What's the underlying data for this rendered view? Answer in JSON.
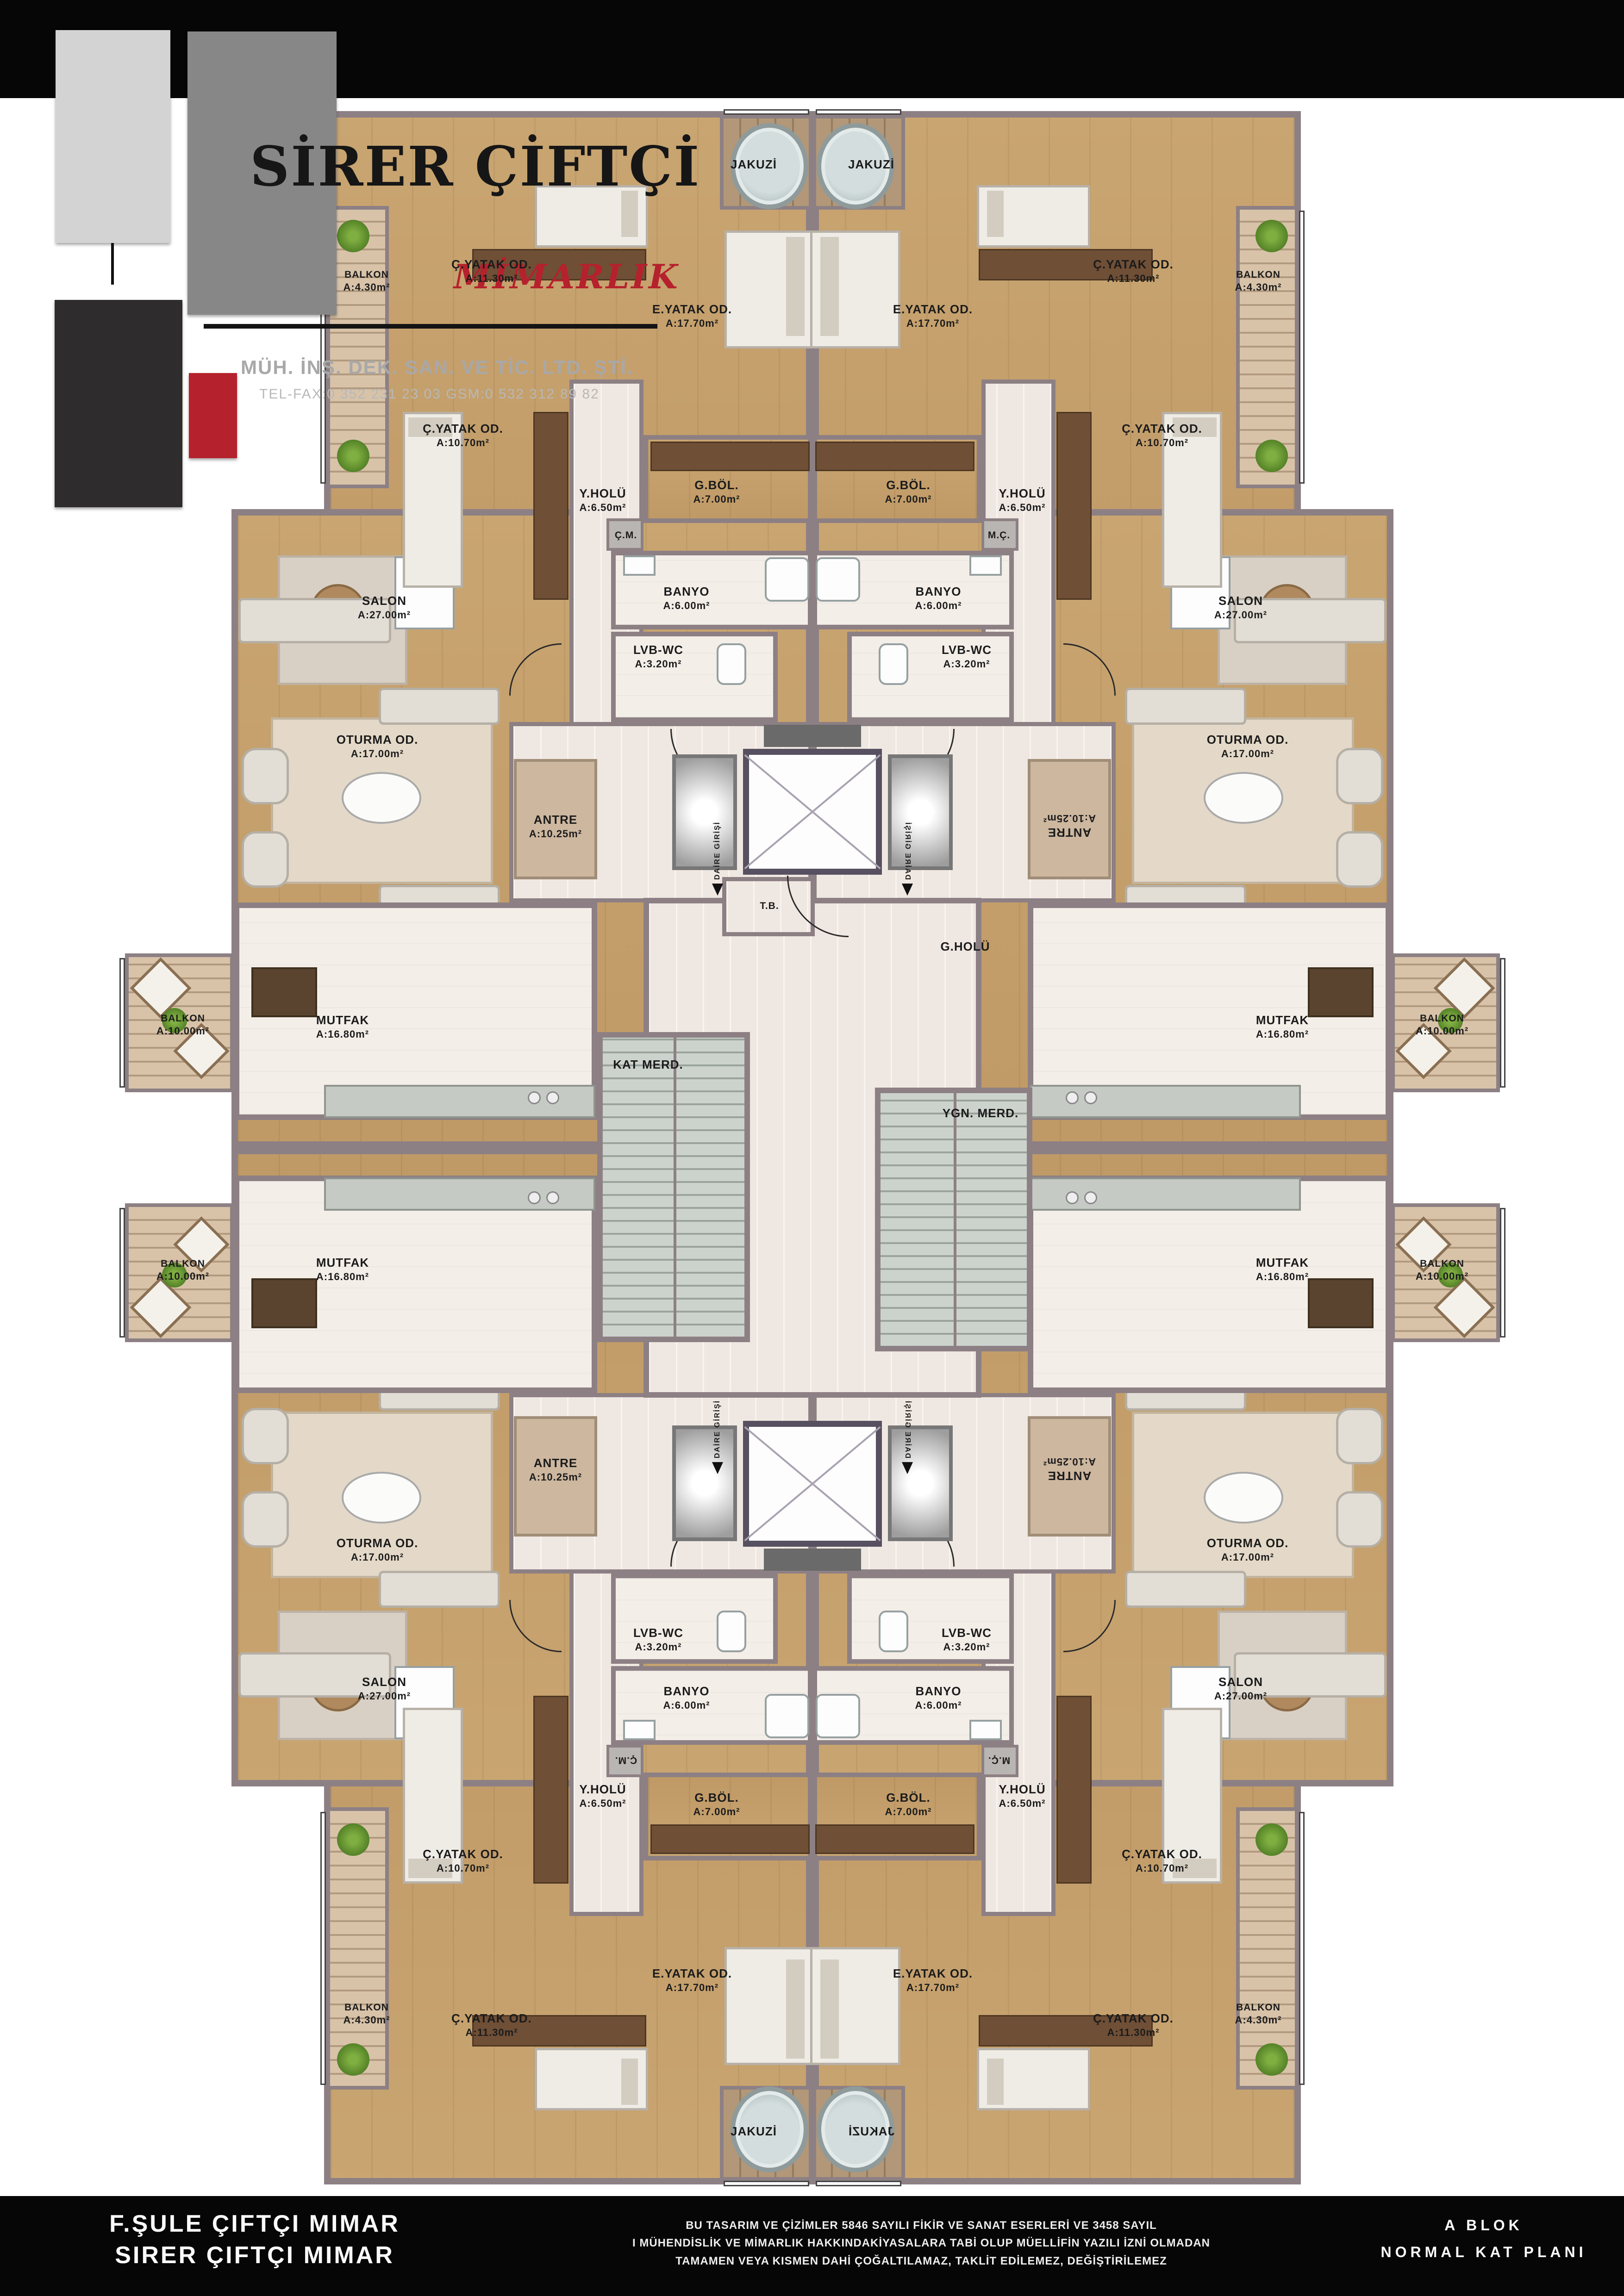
{
  "header": {
    "title": "İBRAHİM BAŞBOĞA",
    "logo": {
      "name": "SİRER ÇİFTÇİ",
      "subtitle": "MİMARLIK",
      "line1": "MÜH. İNŞ. DEK. SAN. VE TİC. LTD. ŞTİ.",
      "line2": "TEL-FAX:0 352 231 23 03    GSM:0 532 312 89 82"
    }
  },
  "plan": {
    "rooms": {
      "jakuzi": {
        "label": "JAKUZİ"
      },
      "balkon430": {
        "label": "BALKON",
        "area": "A:4.30m²"
      },
      "cyatak1130": {
        "label": "Ç.YATAK OD.",
        "area": "A:11.30m²"
      },
      "eyatak": {
        "label": "E.YATAK OD.",
        "area": "A:17.70m²"
      },
      "cyatak1070": {
        "label": "Ç.YATAK OD.",
        "area": "A:10.70m²"
      },
      "yholu": {
        "label": "Y.HOLÜ",
        "area": "A:6.50m²"
      },
      "gbol": {
        "label": "G.BÖL.",
        "area": "A:7.00m²"
      },
      "cm": {
        "label": "Ç.M."
      },
      "mc": {
        "label": "M.Ç."
      },
      "banyo": {
        "label": "BANYO",
        "area": "A:6.00m²"
      },
      "lvbwc": {
        "label": "LVB-WC",
        "area": "A:3.20m²"
      },
      "salon": {
        "label": "SALON",
        "area": "A:27.00m²"
      },
      "oturma": {
        "label": "OTURMA OD.",
        "area": "A:17.00m²"
      },
      "antre": {
        "label": "ANTRE",
        "area": "A:10.25m²"
      },
      "mutfak": {
        "label": "MUTFAK",
        "area": "A:16.80m²"
      },
      "balkon1000": {
        "label": "BALKON",
        "area": "A:10.00m²"
      },
      "katmerd": {
        "label": "KAT MERD."
      },
      "ygnmerd": {
        "label": "YGN. MERD."
      },
      "tb": {
        "label": "T.B."
      },
      "gholu": {
        "label": "G.HOLÜ"
      },
      "daire": {
        "label": "DAİRE GİRİŞİ"
      }
    }
  },
  "footer": {
    "architect1": "F.ŞULE ÇIFTÇI MIMAR",
    "architect2": "SIRER ÇIFTÇI MIMAR",
    "notice1": "BU TASARIM VE ÇİZİMLER 5846 SAYILI FİKİR VE SANAT ESERLERİ VE 3458 SAYIL",
    "notice2": "I MÜHENDİSLİK VE MİMARLIK HAKKINDAKİYASALARA TABİ OLUP MÜELLİFİN YAZILI İZNİ OLMADAN",
    "notice3": "TAMAMEN VEYA KISMEN DAHİ ÇOĞALTILAMAZ, TAKLİT EDİLEMEZ, DEĞİŞTİRİLEMEZ",
    "block": "A BLOK",
    "plan_name": "NORMAL KAT PLANI"
  },
  "colors": {
    "accent_red": "#b5212c",
    "wall": "#8d8084",
    "wood": "#c9a571",
    "deck": "#d7c2a8",
    "cream": "#efe7e1"
  }
}
